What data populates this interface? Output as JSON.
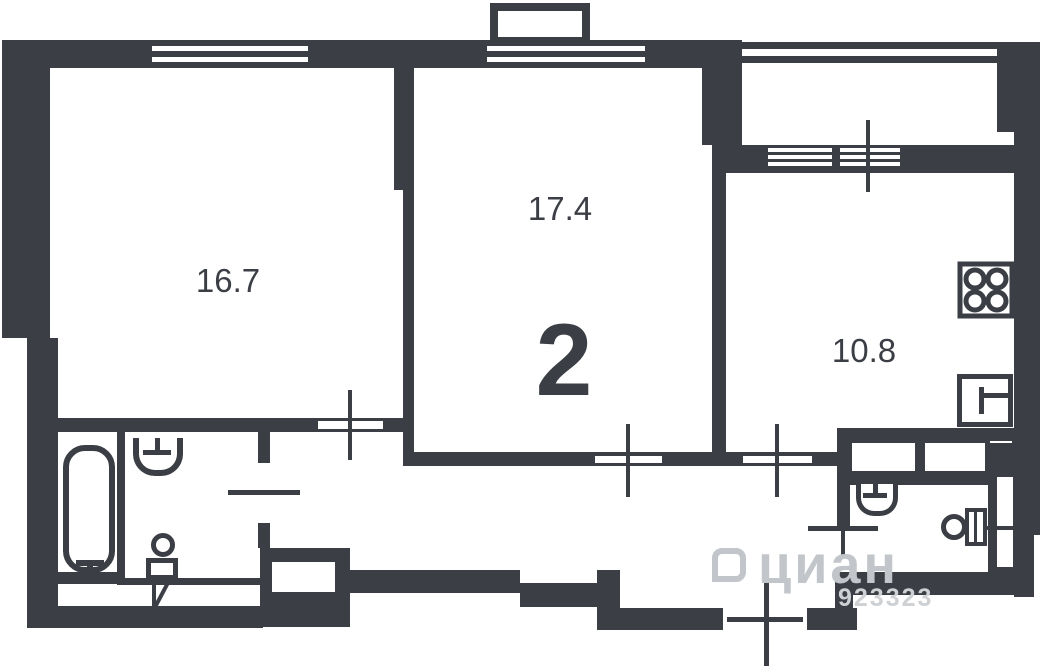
{
  "plan": {
    "room_count_label": "2",
    "rooms": [
      {
        "name": "living-room",
        "area_label": "16.7"
      },
      {
        "name": "bedroom",
        "area_label": "17.4"
      },
      {
        "name": "kitchen",
        "area_label": "10.8"
      }
    ],
    "watermark": {
      "brand": "циан",
      "code": "923323"
    },
    "colors": {
      "wall": "#3b3e44",
      "background": "#ffffff",
      "watermark": "#c2c6ca"
    },
    "icons": [
      "bathtub-icon",
      "sink-icon",
      "toilet-icon",
      "stove-icon",
      "kitchen-sink-icon",
      "window-icon",
      "door-marker-icon"
    ]
  }
}
